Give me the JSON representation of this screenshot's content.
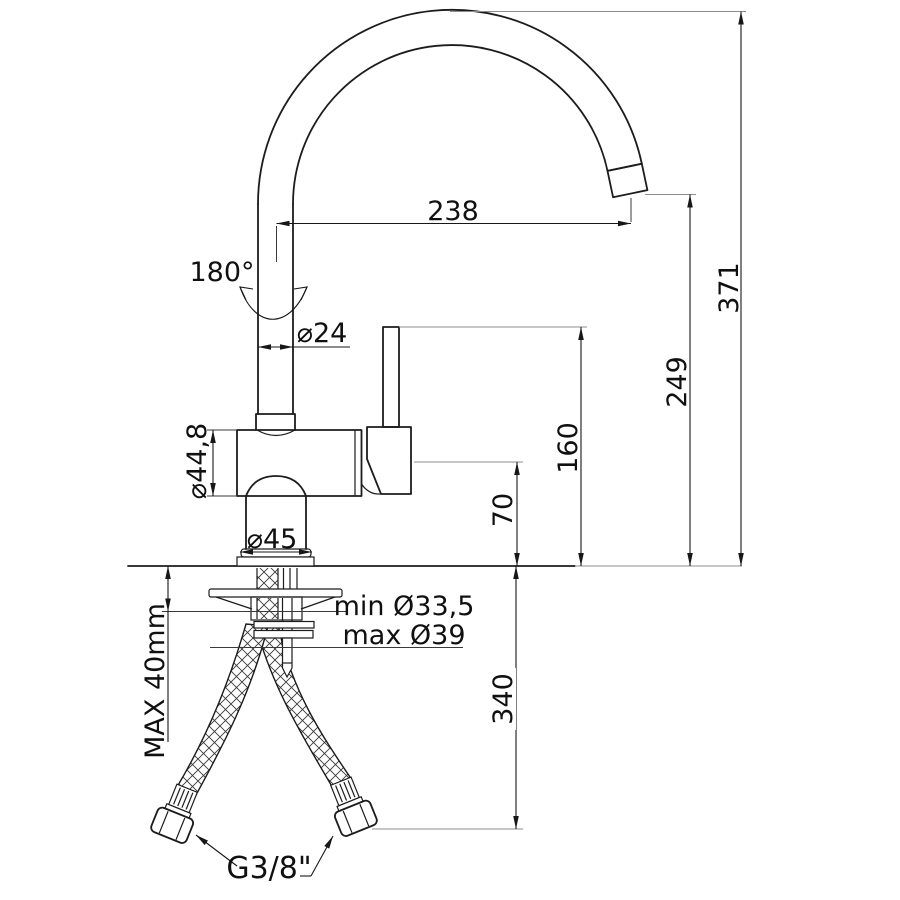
{
  "drawing": {
    "type": "faucet-technical-drawing",
    "dimensions": {
      "spout_reach": "238",
      "total_height": "371",
      "outlet_height": "249",
      "handle_top_height": "160",
      "body_height_above_deck": "70",
      "hose_drop_below_deck": "340",
      "max_counter_thickness": "MAX 40mm",
      "swivel_angle": "180°",
      "spout_tube_diameter": "⌀24",
      "body_diameter": "⌀44,8",
      "base_diameter": "⌀45",
      "hole_min_diameter": "min Ø33,5",
      "hole_max_diameter": "max Ø39",
      "supply_connection": "G3/8\""
    },
    "colors": {
      "object_line": "#1c1c1c",
      "dimension_line": "#171717",
      "extension_line": "#8d8d8d",
      "background": "#ffffff"
    }
  }
}
